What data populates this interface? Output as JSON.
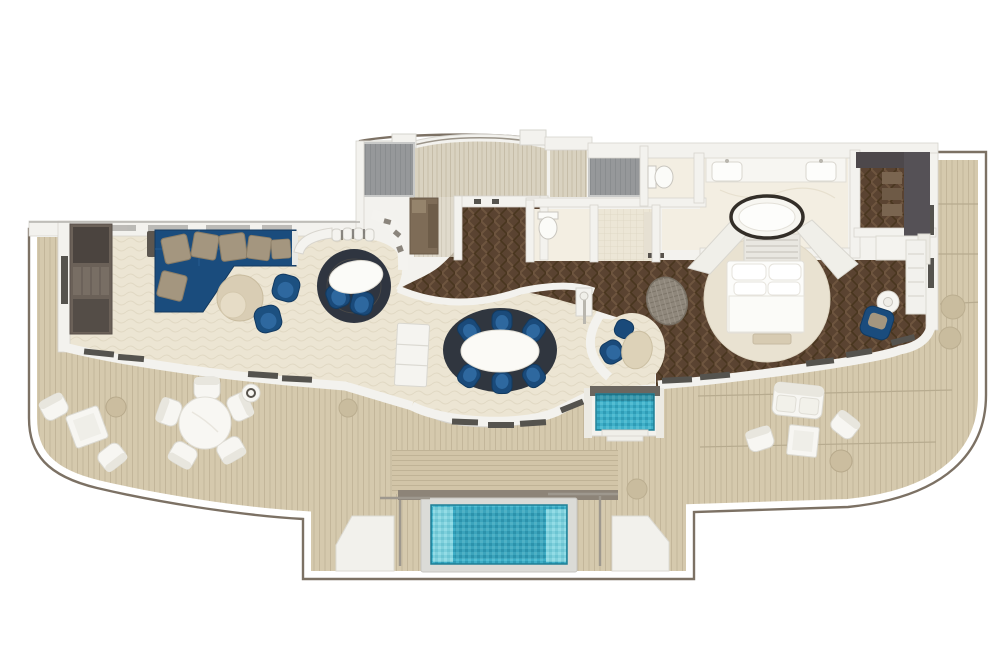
{
  "scene": {
    "kind": "suite-floor-plan",
    "view": "top-down-3d-render",
    "canvas": {
      "width": 1000,
      "height": 666
    }
  },
  "colors": {
    "page": "#ffffff",
    "rail": "#7c7164",
    "deck": "#d5c9ad",
    "deck_line": "#c3b69a",
    "deck_seam": "#b7ab8f",
    "wall": "#f3f2ee",
    "wall_edge": "#d6d4ce",
    "glass": "#55534e",
    "carpet": "#ece5d3",
    "carpet_line": "#e1d9c4",
    "herringbone": "#5a4331",
    "herringbone_dark": "#49361f",
    "herringbone_light": "#6e553f",
    "marble": "#f3eee2",
    "tile": "#ece6d6",
    "closet_gray": "#96989a",
    "tambour": "#d9d2c0",
    "sofa_navy": "#1a4c7d",
    "sofa_highlight": "#2e689f",
    "chair_blue": "#1a4a7a",
    "pillow_taupe": "#a4967f",
    "table_beige": "#d9cdb4",
    "rug_dark": "#30363f",
    "white_furniture": "#f7f6f2",
    "white_furniture_edge": "#dbd9d1",
    "pool_water": "#3fafc8",
    "pool_water_light": "#7fd0dc",
    "pool_water_dark": "#1f7f96",
    "wood_cabinet": "#7e6c57",
    "media_cabinet": "#6b6158",
    "tub_ring": "#332e28",
    "pouf_weave": "#8f877b"
  },
  "rooms": [
    {
      "id": "living-room",
      "floor": "carpet"
    },
    {
      "id": "media-lounge",
      "floor": "carpet"
    },
    {
      "id": "bar",
      "floor": "carpet"
    },
    {
      "id": "dining-area",
      "floor": "carpet"
    },
    {
      "id": "entry-foyer",
      "floor": "herringbone-wood"
    },
    {
      "id": "hallway",
      "floor": "herringbone-wood"
    },
    {
      "id": "pantry",
      "floor": "light-wood"
    },
    {
      "id": "closet-left",
      "floor": "gray"
    },
    {
      "id": "closet-center",
      "floor": "gray"
    },
    {
      "id": "guest-wc",
      "floor": "marble"
    },
    {
      "id": "shower-room",
      "floor": "tile"
    },
    {
      "id": "toilet-room",
      "floor": "marble"
    },
    {
      "id": "master-bathroom",
      "floor": "marble"
    },
    {
      "id": "bedroom",
      "floor": "herringbone-wood"
    },
    {
      "id": "walk-in-closet",
      "floor": "herringbone-wood"
    },
    {
      "id": "breakfast-nook",
      "floor": "carpet"
    },
    {
      "id": "wraparound-deck",
      "floor": "teak-planks"
    }
  ],
  "features": [
    {
      "id": "plunge-pool",
      "color_ref": "pool_water"
    },
    {
      "id": "whirlpool-tub",
      "color_ref": "pool_water"
    },
    {
      "id": "pool-platform-left"
    },
    {
      "id": "pool-platform-right"
    },
    {
      "id": "pool-handrails"
    },
    {
      "id": "curved-headboard-wall"
    },
    {
      "id": "curved-entry-wall"
    },
    {
      "id": "deck-railing"
    }
  ],
  "furniture": [
    {
      "id": "sectional-sofa",
      "room": "living-room",
      "color_ref": "sofa_navy",
      "pillows": 6
    },
    {
      "id": "round-coffee-table",
      "room": "living-room",
      "color_ref": "table_beige"
    },
    {
      "id": "swivel-chairs-blue",
      "room": "living-room",
      "count": 2
    },
    {
      "id": "media-wall-cabinet",
      "room": "living-room"
    },
    {
      "id": "round-rug",
      "room": "media-lounge",
      "color_ref": "rug_dark"
    },
    {
      "id": "oval-cocktail-table",
      "room": "media-lounge"
    },
    {
      "id": "lounge-chairs-blue",
      "room": "media-lounge",
      "count": 2
    },
    {
      "id": "curved-bar-counter",
      "room": "bar",
      "stools": 4
    },
    {
      "id": "curved-display-shelf",
      "room": "bar"
    },
    {
      "id": "oval-dining-table",
      "room": "dining-area",
      "seats": 6
    },
    {
      "id": "dining-chairs-blue",
      "room": "dining-area",
      "count": 6
    },
    {
      "id": "round-rug",
      "room": "dining-area",
      "color_ref": "rug_dark"
    },
    {
      "id": "console-cabinet",
      "room": "dining-area"
    },
    {
      "id": "floor-lamp",
      "room": "dining-area"
    },
    {
      "id": "bistro-table",
      "room": "breakfast-nook",
      "chairs": 2
    },
    {
      "id": "woven-pouf",
      "room": "hallway"
    },
    {
      "id": "king-bed",
      "room": "bedroom"
    },
    {
      "id": "foot-bench",
      "room": "bedroom"
    },
    {
      "id": "round-rug-cream",
      "room": "bedroom"
    },
    {
      "id": "side-table",
      "room": "bedroom"
    },
    {
      "id": "armchair-blue",
      "room": "bedroom"
    },
    {
      "id": "tv-console",
      "room": "bedroom"
    },
    {
      "id": "oval-bathtub",
      "room": "master-bathroom"
    },
    {
      "id": "double-vanity",
      "room": "master-bathroom",
      "sinks": 2
    },
    {
      "id": "toilet",
      "room": "toilet-room"
    },
    {
      "id": "toilet",
      "room": "guest-wc"
    },
    {
      "id": "wardrobes",
      "room": "walk-in-closet"
    },
    {
      "id": "dresser",
      "room": "walk-in-closet"
    },
    {
      "id": "round-dining-table-outdoor",
      "room": "wraparound-deck",
      "chairs": 5
    },
    {
      "id": "outdoor-side-table",
      "room": "wraparound-deck"
    },
    {
      "id": "lounge-cluster-left",
      "room": "wraparound-deck",
      "pieces": [
        "chair",
        "chair",
        "square-table",
        "pouf"
      ]
    },
    {
      "id": "lounge-cluster-right",
      "room": "wraparound-deck",
      "pieces": [
        "loveseat",
        "chair",
        "chair",
        "square-table",
        "pouf"
      ]
    },
    {
      "id": "deck-poufs",
      "room": "wraparound-deck",
      "count": 4
    }
  ]
}
